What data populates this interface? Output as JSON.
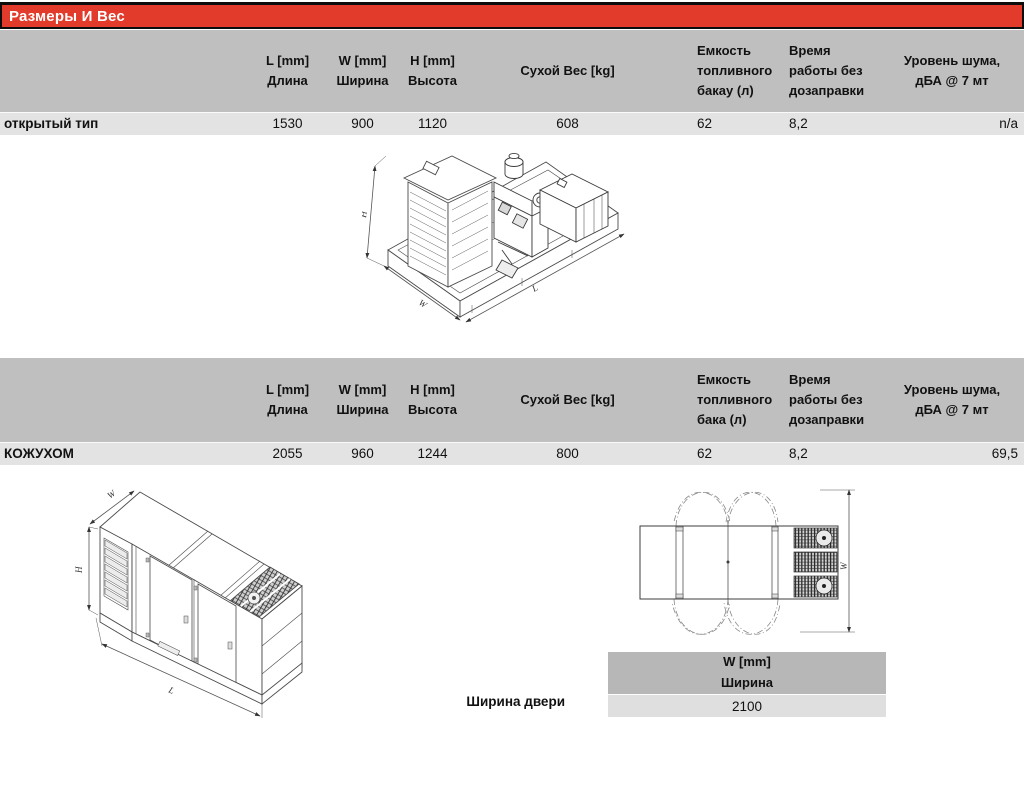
{
  "title_bar": {
    "label": "Размеры И Вес"
  },
  "colors": {
    "accent_red": "#e23b2b",
    "header_gray": "#bfbfbf",
    "row_gray": "#e3e3e3",
    "door_header_gray": "#b7b7b7",
    "door_row_gray": "#dfdfdf"
  },
  "open_table": {
    "headers": {
      "length": "L [mm]\nДлина",
      "width": "W [mm]\nШирина",
      "height": "H  [mm]\nВысота",
      "dry_weight": "Сухой Вес [kg]",
      "fuel_tank": "Емкость\nтопливного\nбакау (л)",
      "runtime": "Время\nработы без\nдозаправки",
      "noise": "Уровень шума,\nдБА @ 7 мт"
    },
    "row": {
      "label": "открытый тип",
      "length": "1530",
      "width": "900",
      "height": "1120",
      "dry_weight": "608",
      "fuel_tank": "62",
      "runtime": "8,2",
      "noise": "n/a"
    }
  },
  "canopy_table": {
    "headers": {
      "length": "L [mm]\nДлина",
      "width": "W [mm]\nШирина",
      "height": "H  [mm]\nВысота",
      "dry_weight": "Сухой Вес [kg]",
      "fuel_tank": "Емкость\nтопливного\nбака (л)",
      "runtime": "Время\nработы без\nдозаправки",
      "noise": "Уровень шума,\nдБА @ 7 мт"
    },
    "row": {
      "label": "КОЖУХОМ",
      "length": "2055",
      "width": "960",
      "height": "1244",
      "dry_weight": "800",
      "fuel_tank": "62",
      "runtime": "8,2",
      "noise": "69,5"
    }
  },
  "door_table": {
    "header": "W [mm]\nШирина",
    "row_label": "Ширина двери",
    "value": "2100"
  },
  "drawings": {
    "open_genset": {
      "dim_height": "H",
      "dim_width": "W",
      "dim_length": "L"
    },
    "canopy_genset": {
      "dim_width": "W",
      "dim_height": "H",
      "dim_length": "L"
    },
    "canopy_top_view": {
      "dim_width": "W"
    }
  }
}
